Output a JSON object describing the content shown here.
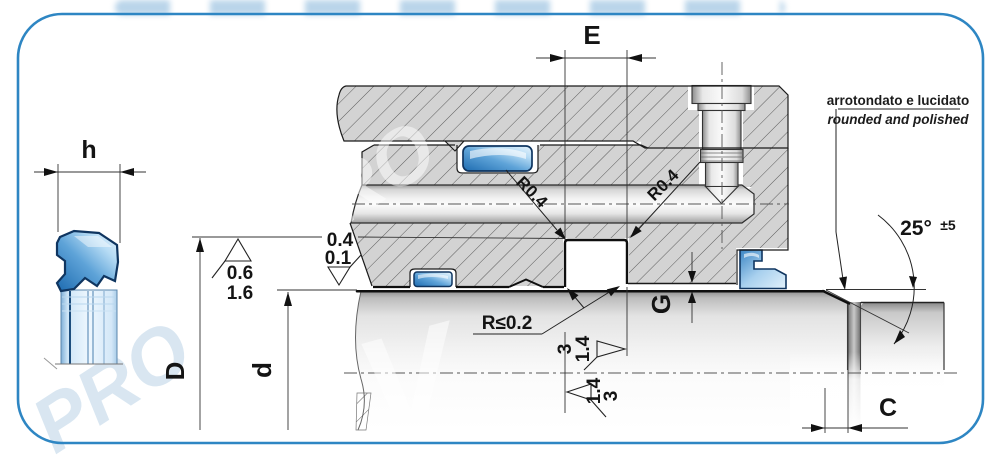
{
  "watermark": {
    "text": "PRO",
    "glyph": "V"
  },
  "side_view": {
    "dim_label": "h"
  },
  "main_view": {
    "dim_labels": {
      "groove_width": "E",
      "groove_bottom_diameter": "D",
      "rod_diameter": "d",
      "clearance_gap": "G",
      "chamfer_length": "C"
    },
    "radii": {
      "groove_top_left": "R0.4",
      "groove_top_right": "R0.4",
      "groove_bottom_edges": "R≤0.2"
    },
    "chamfer_angle": {
      "value": "25°",
      "tolerance": "±5"
    },
    "edge_note": {
      "italian": "arrotondato e lucidato",
      "english": "rounded and polished"
    },
    "surface_finish": {
      "groove_bottom": {
        "upper": "0.6",
        "lower": "1.6"
      },
      "bore": {
        "upper": "0.4",
        "lower": "0.1"
      },
      "groove_flank_right": {
        "first": "3",
        "second": "1.4"
      },
      "groove_flank_left": {
        "first": "1.4",
        "second": "3"
      }
    },
    "colors": {
      "frame_border": "#2e86c3",
      "seal_blue": "#2273bb",
      "metal_gray": "#d3d3d3"
    }
  }
}
